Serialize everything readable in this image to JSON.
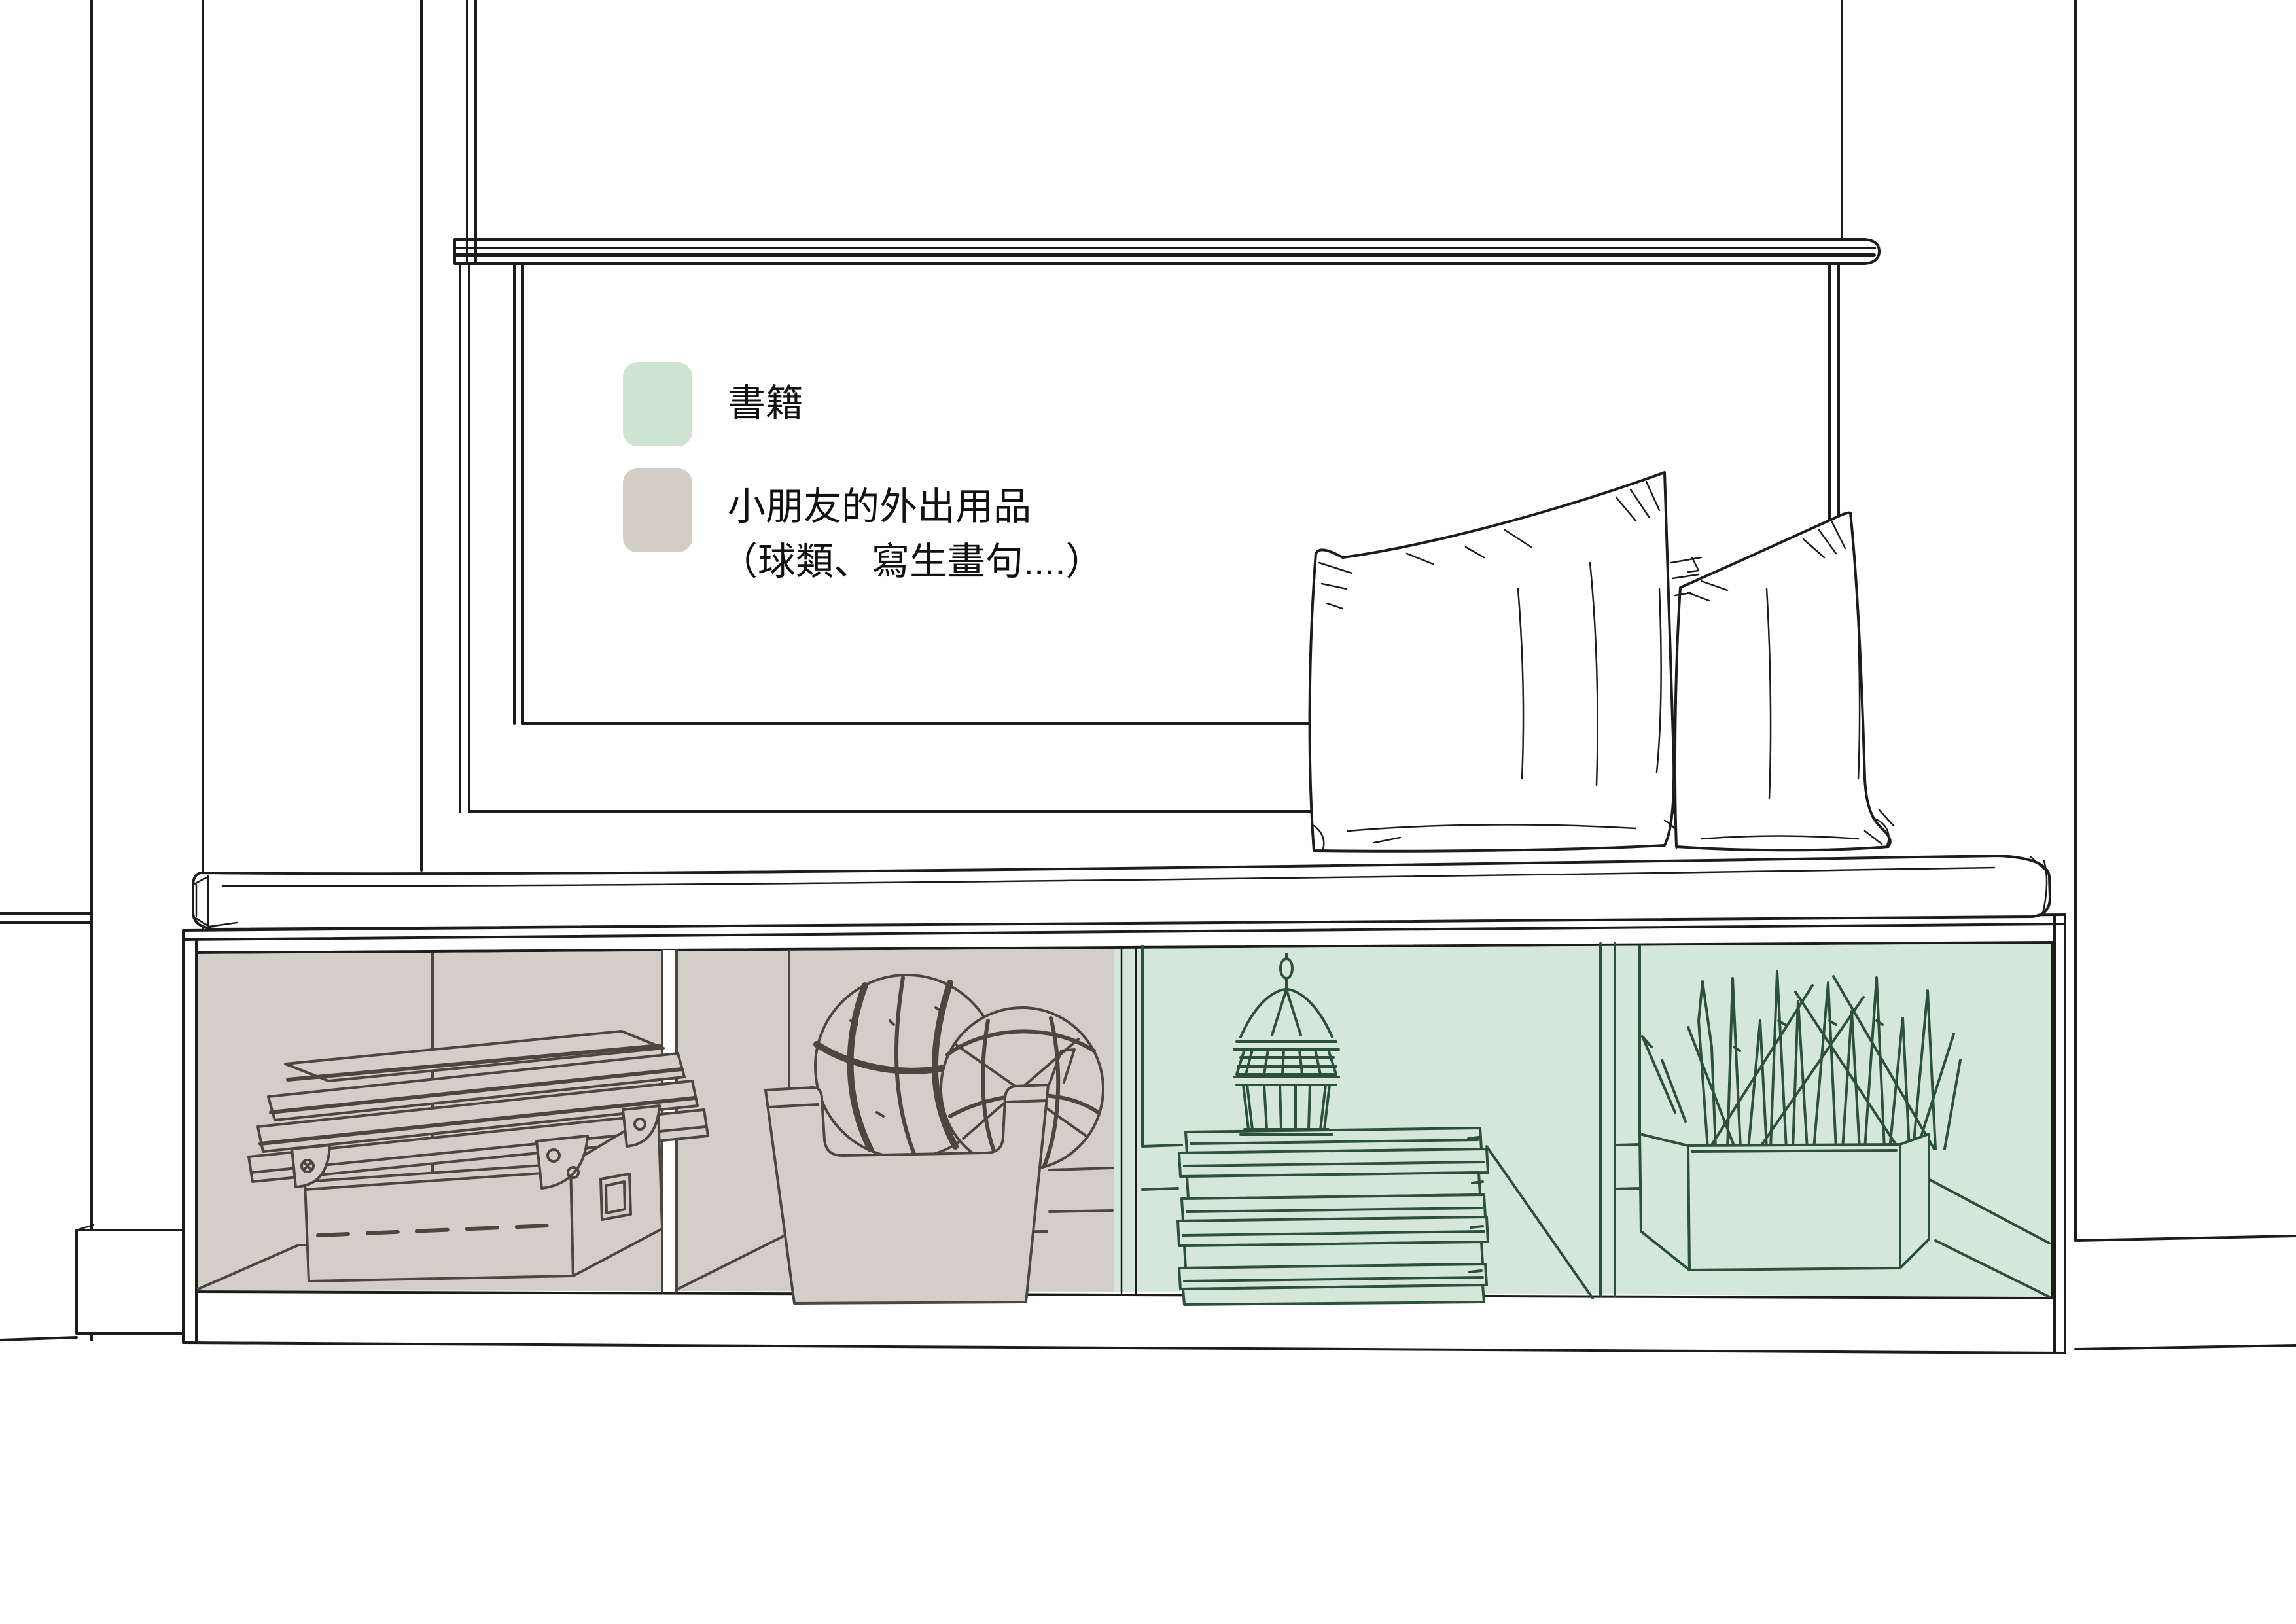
{
  "legend": {
    "items": [
      {
        "id": "books",
        "label": "書籍",
        "swatch_color": "#cfe3d3"
      },
      {
        "id": "kids_outing_items",
        "label": "小朋友的外出用品",
        "label_note": "（球類、寫生畫句....）",
        "swatch_color": "#d2cec5"
      }
    ]
  },
  "colors": {
    "background": "#ffffff",
    "outline": "#1c1c1c",
    "gray_overlay": "#d3cfc8",
    "gray_item_line": "#4c463e",
    "green_overlay": "#d4e7d8",
    "green_item_line": "#2c5039",
    "legend_text": "#111111"
  }
}
